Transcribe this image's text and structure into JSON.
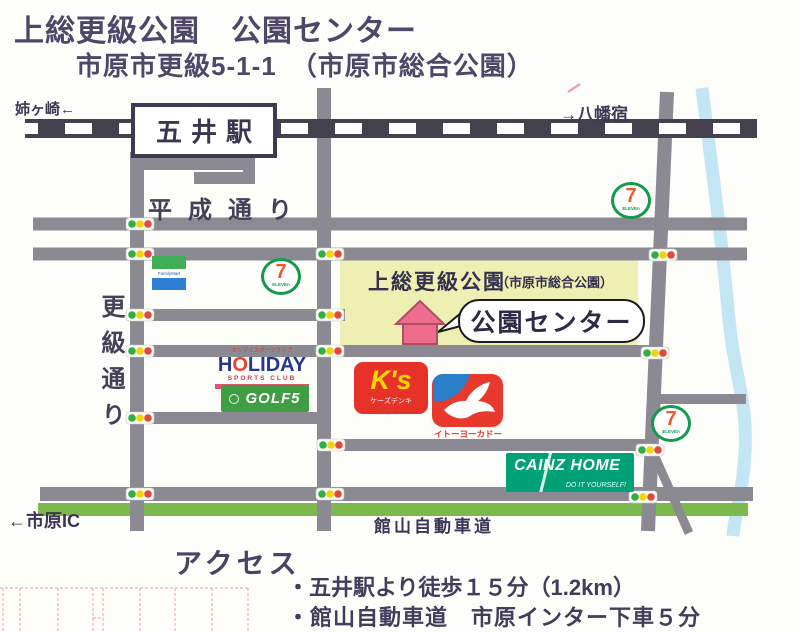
{
  "header": {
    "title": "上総更級公園　公園センター",
    "address": "市原市更級5-1-1　（市原市総合公園）"
  },
  "map": {
    "station_label": "五井駅",
    "dir_left": "姉ヶ崎←",
    "dir_right": "→八幡宿",
    "road_heisei": "平成通り",
    "road_sarashina": "更級通り",
    "expressway_label": "館山自動車道",
    "ic_label": "←市原IC",
    "park_name": "上総更級公園",
    "park_sub": "（市原市総合公園）",
    "bubble_label": "公園センター",
    "shops": {
      "familymart": "FamilyMart",
      "seven_big": "7",
      "seven_small": "ELEVEn",
      "holiday_top": "ホリデイスポーツクラブ",
      "holiday_h": "H",
      "holiday_o": "O",
      "holiday_rest": "LIDAY",
      "holiday_sub": "SPORTS CLUB",
      "golf5": "GOLF5",
      "ks_name": "K's",
      "ks_sub": "ケーズデンキ",
      "yokado": "イトーヨーカドー",
      "cainz_name": "CAINZ HOME",
      "cainz_sub": "DO IT YOURSELF!"
    }
  },
  "access": {
    "heading": "アクセス",
    "items": [
      "・五井駅より徒歩１５分（1.2km）",
      "・館山自動車道　市原インター下車５分"
    ]
  },
  "colors": {
    "ink": "#4e4769",
    "road": "#8b8992",
    "railway": "#44404e",
    "park_fill": "#edefb3",
    "river": "#c3e5f4",
    "expressway_green": "#7db84c",
    "signal_green": "#2fae46",
    "signal_yellow": "#f2d40e",
    "signal_red": "#e2483d",
    "house_pink": "#ee6d8d"
  }
}
